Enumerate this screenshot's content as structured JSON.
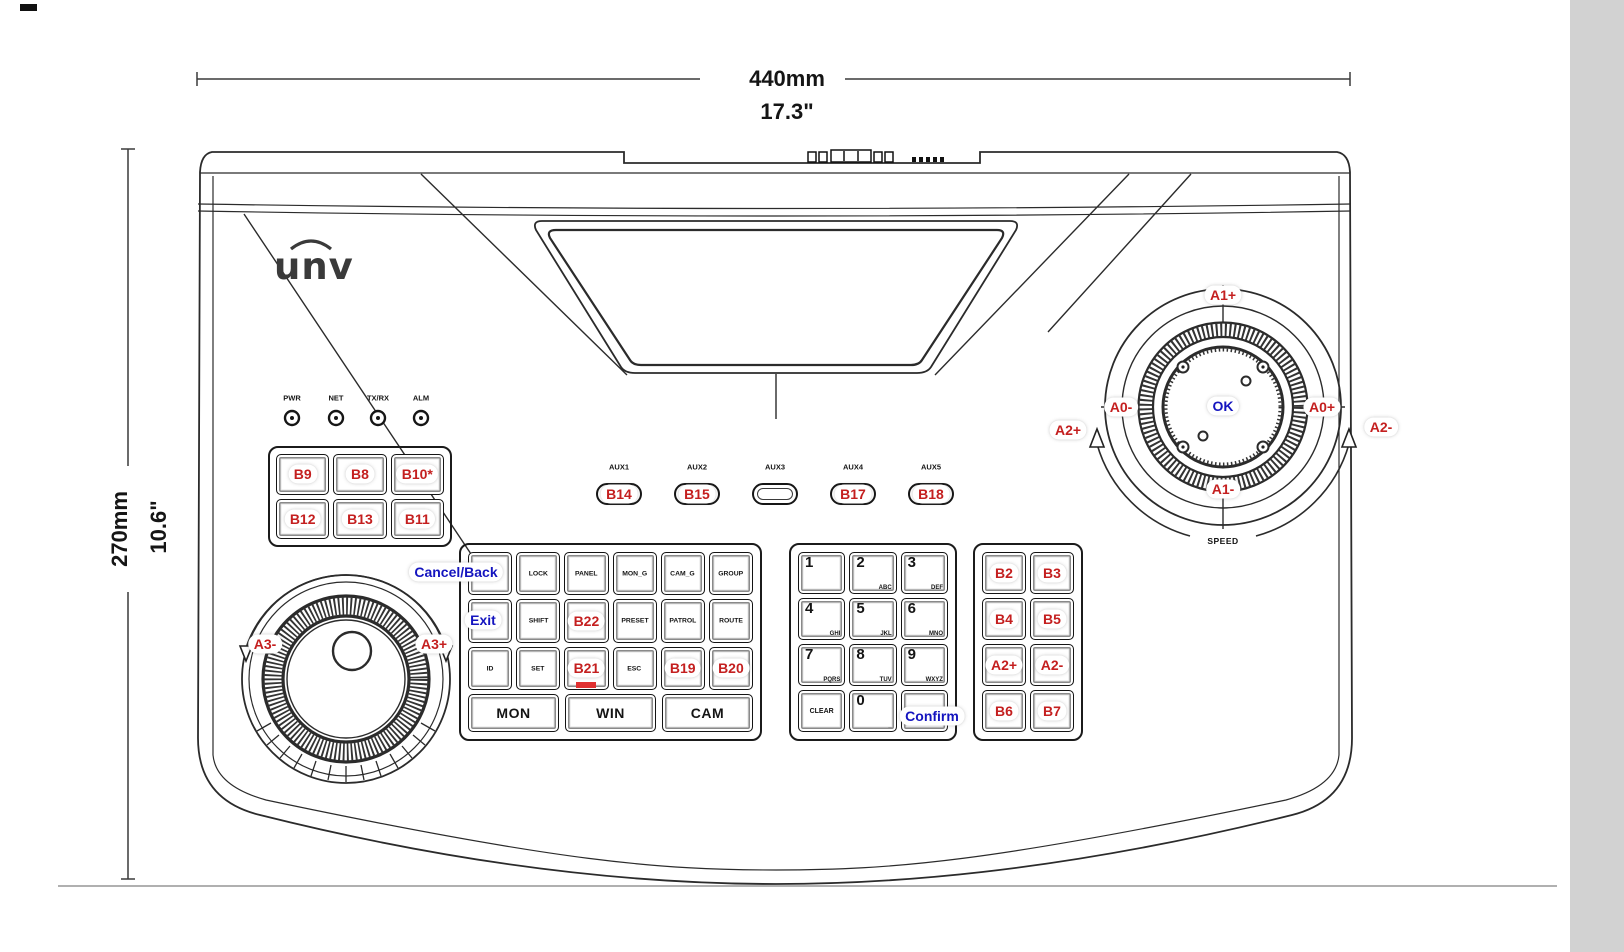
{
  "colors": {
    "badge_red": "#c41f1f",
    "badge_blue": "#1414bf",
    "line": "#2b2b2b"
  },
  "dimensions": {
    "top": {
      "mm": "440mm",
      "inch": "17.3\""
    },
    "left": {
      "mm": "270mm",
      "inch": "10.6\""
    }
  },
  "logo": "unv",
  "leds": [
    "PWR",
    "NET",
    "TX/RX",
    "ALM"
  ],
  "left_keypad": {
    "badges": [
      "B9",
      "B8",
      "B10*",
      "B12",
      "B13",
      "B11"
    ]
  },
  "aux": {
    "labels": [
      "AUX1",
      "AUX2",
      "AUX3",
      "AUX4",
      "AUX5"
    ],
    "badges": [
      "B14",
      "B15",
      "",
      "B17",
      "B18"
    ]
  },
  "main_keypad": {
    "keys": [
      "",
      "LOCK",
      "PANEL",
      "MON_G",
      "CAM_G",
      "GROUP",
      "",
      "SHIFT",
      "",
      "PRESET",
      "PATROL",
      "ROUTE",
      "ID",
      "SET",
      "",
      "ESC",
      "",
      ""
    ],
    "badge_b22": "B22",
    "badge_b21": "B21",
    "badge_b19": "B19",
    "badge_b20": "B20",
    "wide": [
      "MON",
      "WIN",
      "CAM"
    ]
  },
  "numpad": {
    "digits": [
      "1",
      "2",
      "3",
      "4",
      "5",
      "6",
      "7",
      "8",
      "9"
    ],
    "letters": [
      "",
      "ABC",
      "DEF",
      "GHI",
      "JKL",
      "MNO",
      "PQRS",
      "TUV",
      "WXYZ"
    ],
    "clear": "CLEAR",
    "zero": "0",
    "zero_sub": "_"
  },
  "right_keypad": {
    "badges": [
      "B2",
      "B3",
      "B4",
      "B5",
      "A2+",
      "A2-",
      "B6",
      "B7"
    ]
  },
  "joystick": {
    "a1_plus": "A1+",
    "a1_minus": "A1-",
    "a0_minus": "A0-",
    "a0_plus": "A0+",
    "a2_plus": "A2+",
    "a2_minus": "A2-",
    "ok": "OK",
    "speed": "SPEED"
  },
  "jog": {
    "a3_minus": "A3-",
    "a3_plus": "A3+"
  },
  "callouts": {
    "cancel_back": "Cancel/Back",
    "exit": "Exit",
    "confirm": "Confirm"
  }
}
